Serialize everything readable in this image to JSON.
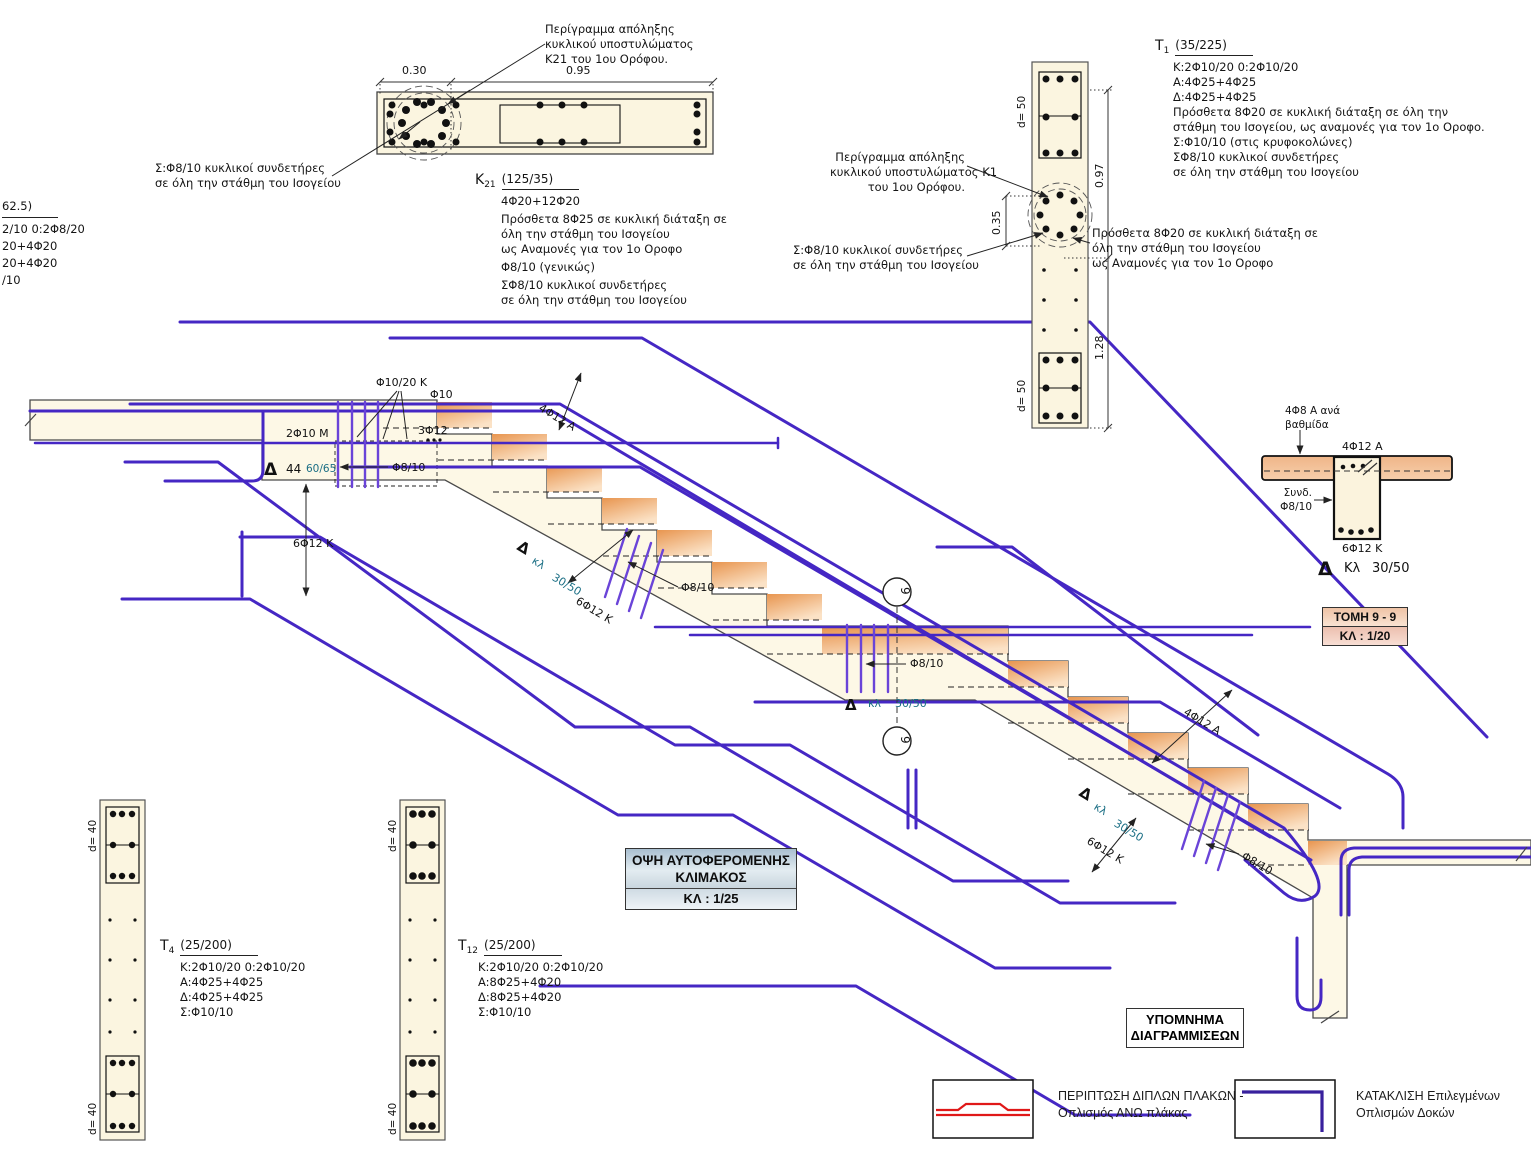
{
  "colors": {
    "rebar": "#4527c4",
    "rebar_light": "#6a44d8",
    "legend_red": "#e01818",
    "legend_purple": "#38209d",
    "teal_label": "#1a6e84",
    "step_orange": "#eda061",
    "concrete_cream": "#fdf8e6"
  },
  "k21": {
    "callout": [
      "Περίγραμμα απόληξης",
      "κυκλικού υποστυλώματος",
      "K21 του 1ου Ορόφου."
    ],
    "dims": {
      "left": "0.30",
      "right": "0.95"
    },
    "tag_main": "K",
    "tag_sub": "21",
    "size": "(125/35)",
    "notes": [
      "4Φ20+12Φ20",
      "Πρόσθετα 8Φ25 σε κυκλική διάταξη σε",
      "όλη την στάθμη του Ισογείου",
      "ως Αναμονές για τον 1ο Οροφο",
      "Φ8/10 (γενικώς)",
      "ΣΦ8/10 κυκλικοί συνδετήρες",
      "σε όλη την στάθμη του Ισογείου"
    ],
    "side_note": [
      "Σ:Φ8/10 κυκλικοί συνδετήρες",
      "σε όλη την στάθμη του Ισογείου"
    ]
  },
  "left_fragment": [
    "62.5)",
    "2/10 0:2Φ8/20",
    "20+4Φ20",
    "20+4Φ20",
    "/10"
  ],
  "t1": {
    "tag_main": "T",
    "tag_sub": "1",
    "size": "(35/225)",
    "notes": [
      "K:2Φ10/20 0:2Φ10/20",
      "A:4Φ25+4Φ25",
      "Δ:4Φ25+4Φ25",
      "Πρόσθετα 8Φ20 σε κυκλική διάταξη σε όλη την",
      "στάθμη του Ισογείου, ως αναμονές για τον 1ο Οροφο.",
      "Σ:Φ10/10 (στις κρυφοκολώνες)",
      "ΣΦ8/10 κυκλικοί συνδετήρες",
      "σε όλη την στάθμη του Ισογείου"
    ],
    "callout": [
      "Περίγραμμα απόληξης",
      "κυκλικού υποστυλώματος K1",
      "του 1ου Ορόφου."
    ],
    "side_note": [
      "Σ:Φ8/10 κυκλικοί συνδετήρες",
      "σε όλη την στάθμη του Ισογείου"
    ],
    "note2": [
      "Πρόσθετα 8Φ20 σε κυκλική διάταξη σε",
      "όλη την στάθμη του Ισογείου",
      "ως Αναμονές για τον 1ο Οροφο"
    ],
    "dims": {
      "h_top": "0.97",
      "h_circle": "0.35",
      "h_bottom": "1.28",
      "d_top": "d= 50",
      "d_bottom": "d= 50"
    }
  },
  "stair": {
    "phi10_20k": "Φ10/20 K",
    "phi10": "Φ10",
    "bar2f10": "2Φ10 M",
    "bar3f12": "3Φ12",
    "delta": "Δ",
    "num44": "44",
    "size6065": "60/65",
    "phi810": "Φ8/10",
    "bar6f12": "6Φ12 K",
    "kl": "κλ",
    "scale3050": "30/50",
    "bar4f12": "4Φ12 A",
    "section_num": "9"
  },
  "beam": {
    "callout": [
      "4Φ8 Α ανά",
      "βαθμίδα"
    ],
    "top_bar": "4Φ12 A",
    "stirrup": [
      "Συνδ.",
      "Φ8/10"
    ],
    "bottom_bar": "6Φ12 K",
    "delta": "Δ",
    "kl": "Κλ",
    "scale": "30/50"
  },
  "tomh_box": {
    "title": "ΤΟΜΗ 9 - 9",
    "scale": "ΚΛ : 1/20"
  },
  "title_block": {
    "line1": "ΟΨΗ ΑΥΤΟΦΕΡΟΜΕΝΗΣ",
    "line2": "ΚΛΙΜΑΚΟΣ",
    "scale": "ΚΛ : 1/25"
  },
  "t4": {
    "tag_main": "T",
    "tag_sub": "4",
    "size": "(25/200)",
    "notes": [
      "K:2Φ10/20 0:2Φ10/20",
      "A:4Φ25+4Φ25",
      "Δ:4Φ25+4Φ25",
      "Σ:Φ10/10"
    ],
    "d_top": "d= 40",
    "d_bottom": "d= 40"
  },
  "t12": {
    "tag_main": "T",
    "tag_sub": "12",
    "size": "(25/200)",
    "notes": [
      "K:2Φ10/20 0:2Φ10/20",
      "A:8Φ25+4Φ20",
      "Δ:8Φ25+4Φ20",
      "Σ:Φ10/10"
    ],
    "d_top": "d= 40",
    "d_bottom": "d= 40"
  },
  "legend": {
    "title": [
      "ΥΠΟΜΝΗΜΑ",
      "ΔΙΑΓΡΑΜΜΙΣΕΩΝ"
    ],
    "item1": [
      "ΠΕΡΙΠΤΩΣΗ ΔΙΠΛΩΝ ΠΛΑΚΩΝ -",
      "Οπλισμός ΑΝΩ πλάκας"
    ],
    "item2": [
      "ΚΑΤΑΚΛΙΣΗ Επιλεγμένων",
      "Οπλισμών Δοκών"
    ]
  }
}
